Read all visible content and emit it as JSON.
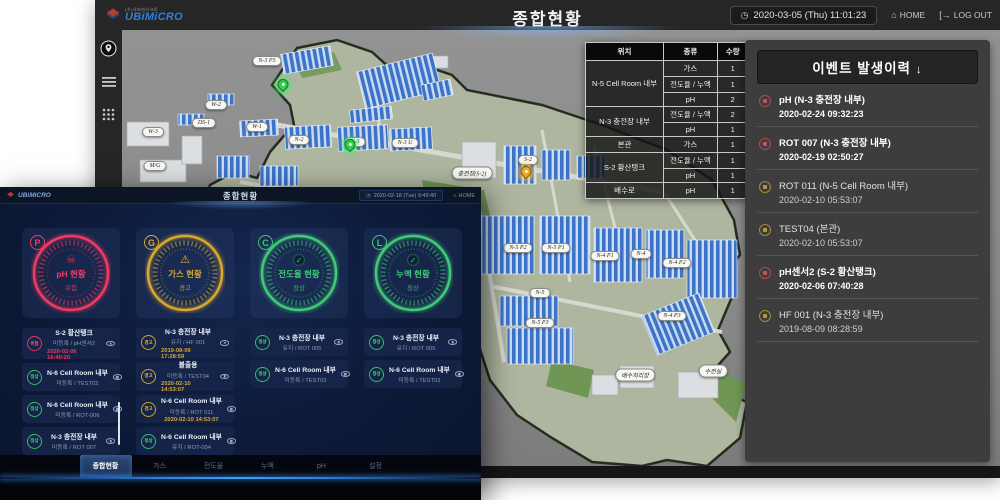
{
  "bg": {
    "topbar": {
      "brand": "UBiMiCRO",
      "brand_sub": "(주)유비마이크로",
      "title": "종합현황",
      "datetime": "2020-03-05 (Thu) 11:01:23",
      "home": "HOME",
      "logout": "LOG OUT"
    },
    "table": {
      "headers": [
        "위치",
        "종류",
        "수량"
      ],
      "groups": [
        {
          "loc": "N-5 Cell Room 내부",
          "entries": [
            [
              "가스",
              "1"
            ],
            [
              "전도율 / 누액",
              "1"
            ],
            [
              "pH",
              "2"
            ]
          ]
        },
        {
          "loc": "N-3 충전장 내부",
          "entries": [
            [
              "전도율 / 누액",
              "2"
            ],
            [
              "pH",
              "1"
            ]
          ]
        },
        {
          "loc": "본관",
          "entries": [
            [
              "가스",
              "1"
            ]
          ]
        },
        {
          "loc": "S-2 황산탱크",
          "entries": [
            [
              "전도율 / 누액",
              "1"
            ],
            [
              "pH",
              "1"
            ]
          ]
        },
        {
          "loc": "배수로",
          "entries": [
            [
              "pH",
              "1"
            ]
          ]
        }
      ]
    },
    "events": {
      "title": "이벤트 발생이력",
      "arrow": "↓",
      "items": [
        {
          "name": "pH (N-3 충전장 내부)",
          "time": "2020-02-24 09:32:23",
          "level": "alarm"
        },
        {
          "name": "ROT 007 (N-3 충전장 내부)",
          "time": "2020-02-19 02:50:27",
          "level": "alarm"
        },
        {
          "name": "ROT 011 (N-5 Cell Room 내부)",
          "time": "2020-02-10 05:53:07",
          "level": "warning"
        },
        {
          "name": "TEST04 (본관)",
          "time": "2020-02-10 05:53:07",
          "level": "warning"
        },
        {
          "name": "pH센서2 (S-2 황산탱크)",
          "time": "2020-02-06 07:40:28",
          "level": "alarm"
        },
        {
          "name": "HF 001 (N-3 충전장 내부)",
          "time": "2019-08-09 08:28:59",
          "level": "warning"
        }
      ]
    },
    "map": {
      "labels": [
        "N-3 P5",
        "W-2",
        "DS-1",
        "W-3",
        "W-1",
        "N-2",
        "N-3",
        "N-3 U",
        "M/G",
        "충전장(S-2)",
        "S-2",
        "N-5 P2",
        "N-5 P1",
        "N-4 P1",
        "N-4",
        "N-4 P2",
        "N-5",
        "N-5 P3",
        "N-4 P3",
        "배수처리장",
        "수전실"
      ]
    }
  },
  "fg": {
    "topbar": {
      "brand": "UBiMiCRO",
      "title": "종합현황",
      "datetime": "2020-02-18 (Tue) 9:49:40",
      "home": "HOME"
    },
    "gauges": [
      {
        "letter": "P",
        "title": "pH 현황",
        "status": "위험",
        "icon": "skull",
        "color": "#f23a60"
      },
      {
        "letter": "G",
        "title": "가스 현황",
        "status": "경고",
        "icon": "warning",
        "color": "#d9a82c"
      },
      {
        "letter": "C",
        "title": "전도율 현황",
        "status": "정상",
        "icon": "check",
        "color": "#3ecb74"
      },
      {
        "letter": "L",
        "title": "누액 현황",
        "status": "정상",
        "icon": "check",
        "color": "#3ecb74"
      }
    ],
    "lists": [
      {
        "items": [
          {
            "badge": "위험",
            "title": "S-2 황산탱크",
            "sub": "미등록 / pH센서2",
            "time": "2020-02-06 16:40:20",
            "level": "red"
          },
          {
            "badge": "정상",
            "title": "N-6 Cell Room 내부",
            "sub": "미등록 / TEST02",
            "time": "",
            "level": "green"
          },
          {
            "badge": "정상",
            "title": "N-6 Cell Room 내부",
            "sub": "미등록 / ROT-006",
            "time": "",
            "level": "green"
          },
          {
            "badge": "정상",
            "title": "N-3 충전장 내부",
            "sub": "미등록 / ROT 007",
            "time": "",
            "level": "green"
          }
        ]
      },
      {
        "items": [
          {
            "badge": "경고",
            "title": "N-3 충전장 내부",
            "sub": "유지 / HF 001",
            "time": "2019-08-09 17:28:59",
            "level": "yellow"
          },
          {
            "badge": "경고",
            "title": "불출용",
            "sub": "미등록 / TEST04",
            "time": "2020-02-10 14:53:07",
            "level": "yellow"
          },
          {
            "badge": "경고",
            "title": "N-6 Cell Room 내부",
            "sub": "미등록 / ROT 011",
            "time": "2020-02-10 14:53:07",
            "level": "yellow"
          },
          {
            "badge": "정상",
            "title": "N-6 Cell Room 내부",
            "sub": "유지 / ROT-004",
            "time": "",
            "level": "green"
          }
        ]
      },
      {
        "items": [
          {
            "badge": "정상",
            "title": "N-3 충전장 내부",
            "sub": "유지 / ROT 005",
            "time": "",
            "level": "green"
          },
          {
            "badge": "정상",
            "title": "N-6 Cell Room 내부",
            "sub": "미등록 / TEST03",
            "time": "",
            "level": "green"
          }
        ]
      },
      {
        "items": [
          {
            "badge": "정상",
            "title": "N-3 충전장 내부",
            "sub": "유지 / ROT 005",
            "time": "",
            "level": "green"
          },
          {
            "badge": "정상",
            "title": "N-6 Cell Room 내부",
            "sub": "미등록 / TEST03",
            "time": "",
            "level": "green"
          }
        ]
      }
    ],
    "tabs": [
      "종합현황",
      "가스",
      "전도율",
      "누액",
      "pH",
      "설정"
    ]
  }
}
